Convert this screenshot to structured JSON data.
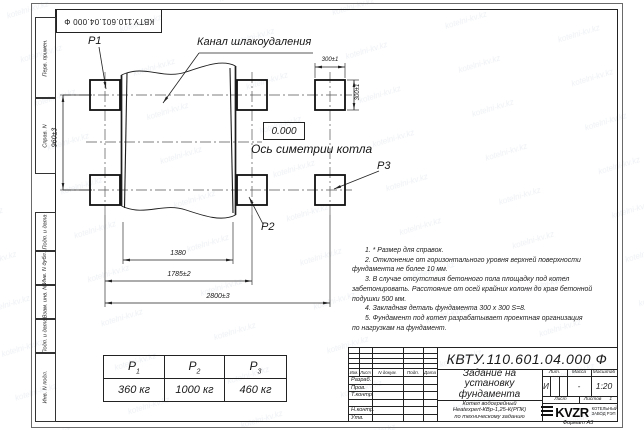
{
  "watermark": {
    "text": "kotelni-kv.kz"
  },
  "corner_stamp": {
    "doc_number": "КВТУ.110.601.04.000 Ф"
  },
  "sidebar": {
    "items": [
      {
        "label": "Перв. примен."
      },
      {
        "label": "Справ. N"
      },
      {
        "label": "Подп. и дата"
      },
      {
        "label": "Инв. N дубл."
      },
      {
        "label": "Взам. инв. N"
      },
      {
        "label": "Подп. и дата"
      },
      {
        "label": "Инв. N подл."
      }
    ]
  },
  "drawing": {
    "channel_label": "Канал шлакоудаления",
    "elevation": "0.000",
    "axis_label": "Ось симетрии котла",
    "p1": "P1",
    "p2": "P2",
    "p3": "P3",
    "dims": {
      "height": "960±3",
      "inner": "1380",
      "middle": "1785±2",
      "overall": "2800±3",
      "pad_w": "300±1",
      "pad_h": "300±1"
    }
  },
  "load_table": {
    "headers": [
      {
        "base": "Р",
        "sub": "1"
      },
      {
        "base": "Р",
        "sub": "2"
      },
      {
        "base": "Р",
        "sub": "3"
      }
    ],
    "values": [
      "360 кг",
      "1000 кг",
      "460 кг"
    ]
  },
  "notes": {
    "lines": [
      "1. * Размер для справок.",
      "2. Отклонение от горизонтального уровня верхней поверхности",
      "фундамента не более 10 мм.",
      "3. В случае отсутствия бетонного пола площадку под котел",
      "забетонировать. Расстояние от осей крайних колонн до края бетонной",
      "подушки 500 мм.",
      "4. Закладная деталь фундамента  300 x 300 S=8.",
      "5. Фундамент под котел разрабатывает проектная организация",
      "по нагрузкам на фундамент."
    ]
  },
  "title_block": {
    "doc_number": "КВТУ.110.601.04.000 Ф",
    "title_lines": [
      "Задание на",
      "установку",
      "фундамента"
    ],
    "product_lines": [
      "Котел водогрейный",
      "Heatexpert-КВр-1,25-К(РПК)",
      "по техническому заданию"
    ],
    "cols": {
      "izm": "Изм.",
      "list": "Лист",
      "doc": "N докум.",
      "podp": "Подп.",
      "data": "Дата"
    },
    "rows": [
      "Разраб.",
      "Пров.",
      "Т.контр.",
      "",
      "Н.контр.",
      "Утв."
    ],
    "lit_label": "Лит.",
    "mass_label": "Масса",
    "scale_label": "Масштаб",
    "lit": "И",
    "mass": "-",
    "scale": "1:20",
    "sheet_label": "Лист",
    "sheets_label": "Листов",
    "sheets_count": "1",
    "logo": {
      "text": "KVZR",
      "caption": [
        "КОТЕЛЬНЫЙ",
        "ЗАВОД РЭП"
      ]
    }
  },
  "page": {
    "format": "Формат А3"
  },
  "colors": {
    "line": "#222222",
    "watermark": "#6e87a8"
  }
}
